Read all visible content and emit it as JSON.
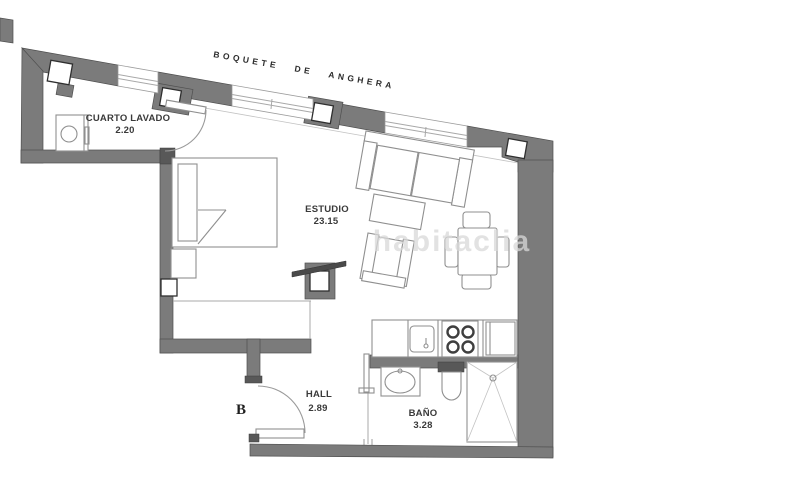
{
  "plan": {
    "street_label": "BOQUETE  DE  ANGHERA",
    "entrance_label": "B",
    "watermark": "habitaclia",
    "rooms": {
      "laundry": {
        "name": "CUARTO LAVADO",
        "area": "2.20"
      },
      "studio": {
        "name": "ESTUDIO",
        "area": "23.15"
      },
      "hall": {
        "name": "HALL",
        "area": "2.89"
      },
      "bath": {
        "name": "BAÑO",
        "area": "3.28"
      }
    }
  },
  "colors": {
    "background": "#ffffff",
    "wall": "#7b7b7b",
    "wall-dark": "#585858",
    "text": "#3a3a3a",
    "watermark": "#d9d9d9"
  }
}
